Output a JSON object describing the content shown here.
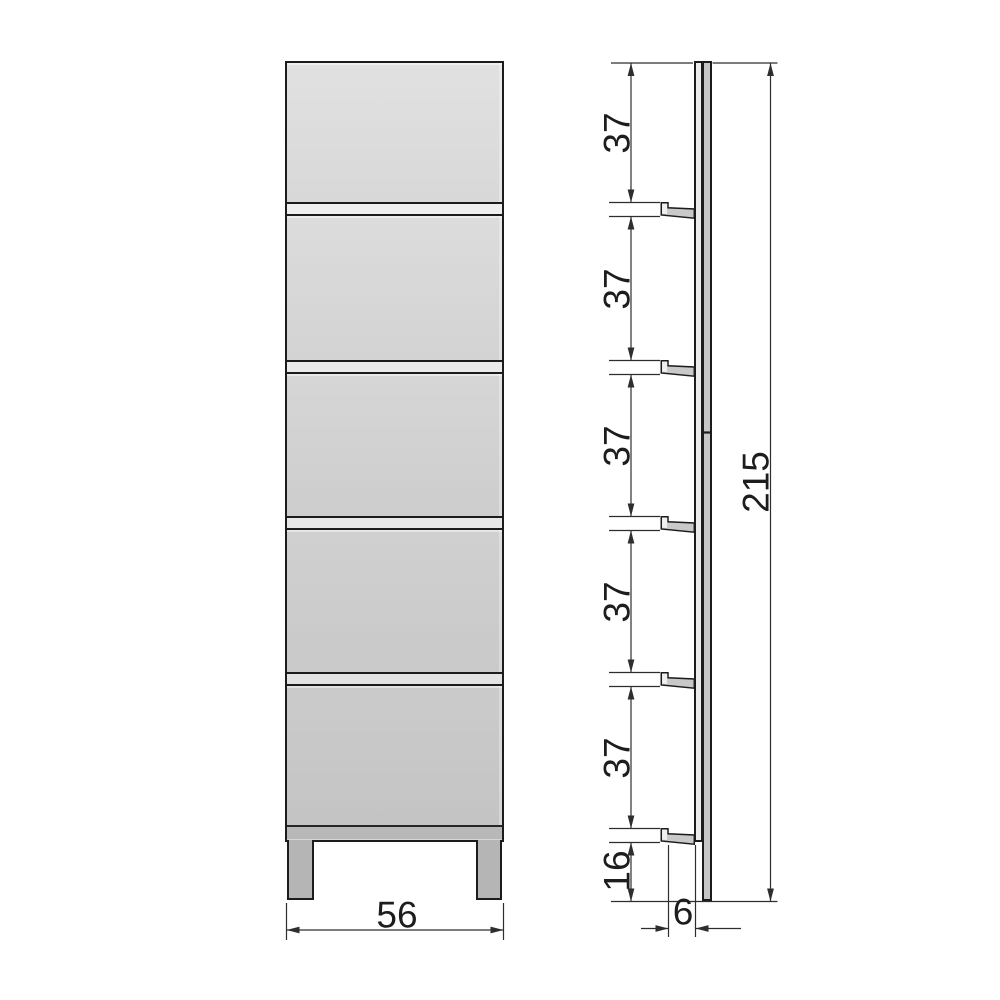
{
  "drawing": {
    "type": "furniture-dimension-drawing",
    "front_view": {
      "width_dimension": "56",
      "door_panels": 5,
      "legs": 2
    },
    "side_view": {
      "shelf_spacing_dimensions": [
        "37",
        "37",
        "37",
        "37",
        "37"
      ],
      "bottom_offset_dimension": "16",
      "total_height_dimension": "215",
      "depth_dimension": "6",
      "wall_hooks": 5
    },
    "colors": {
      "background": "#ffffff",
      "outline": "#1c1c1c",
      "dimension_line": "#2e2e2e",
      "label_text": "#1d1d1d",
      "door_light": "#e1e1e1",
      "door_dark": "#c4c4c4",
      "divider_strip": "#ececec",
      "base_rail": "#b8b8b8",
      "leg": "#b5b5b5",
      "side_front_strip": "#ececec",
      "side_back_strip": "#c6c6c6",
      "hook_fill": "#c9c9c9"
    }
  }
}
